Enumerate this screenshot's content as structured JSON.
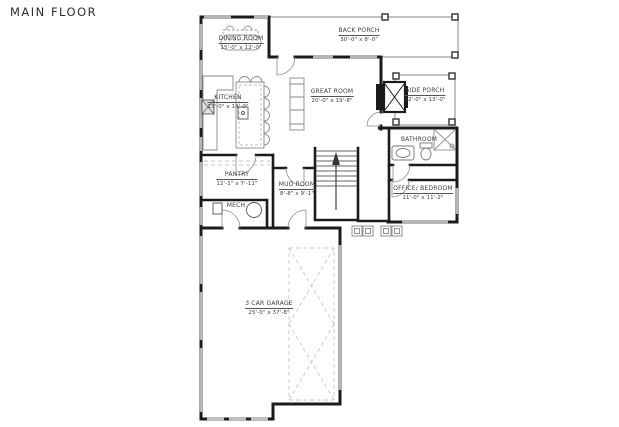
{
  "title": "MAIN FLOOR",
  "rooms": {
    "dining": {
      "name": "DINING ROOM",
      "dims": "15'-0\" x 12'-0\""
    },
    "back_porch": {
      "name": "BACK PORCH",
      "dims": "30'-0\" x 8'-0\""
    },
    "kitchen": {
      "name": "KITCHEN",
      "dims": "13'-0\" x 14'-0\""
    },
    "great_room": {
      "name": "GREAT ROOM",
      "dims": "20'-0\" x 19'-8\""
    },
    "side_porch": {
      "name": "SIDE PORCH",
      "dims": "12'-0\" x 13'-0\""
    },
    "bathroom": {
      "name": "BATHROOM",
      "dims": ""
    },
    "pantry": {
      "name": "PANTRY",
      "dims": "12'-1\" x 7'-11\""
    },
    "mud_room": {
      "name": "MUD ROOM",
      "dims": "8'-8\" x 9'-1\""
    },
    "office_bedroom": {
      "name": "OFFICE/ BEDROOM",
      "dims": "11'-0\" x 11'-2\""
    },
    "mech": {
      "name": "MECH",
      "dims": ""
    },
    "garage": {
      "name": "3 CAR GARAGE",
      "dims": "25'-0\" x 37'-8\""
    }
  },
  "colors": {
    "wall": "#1b1b1b",
    "window": "#b5b5b5",
    "annotation": "#3c3c3c",
    "porch": "#999999"
  }
}
